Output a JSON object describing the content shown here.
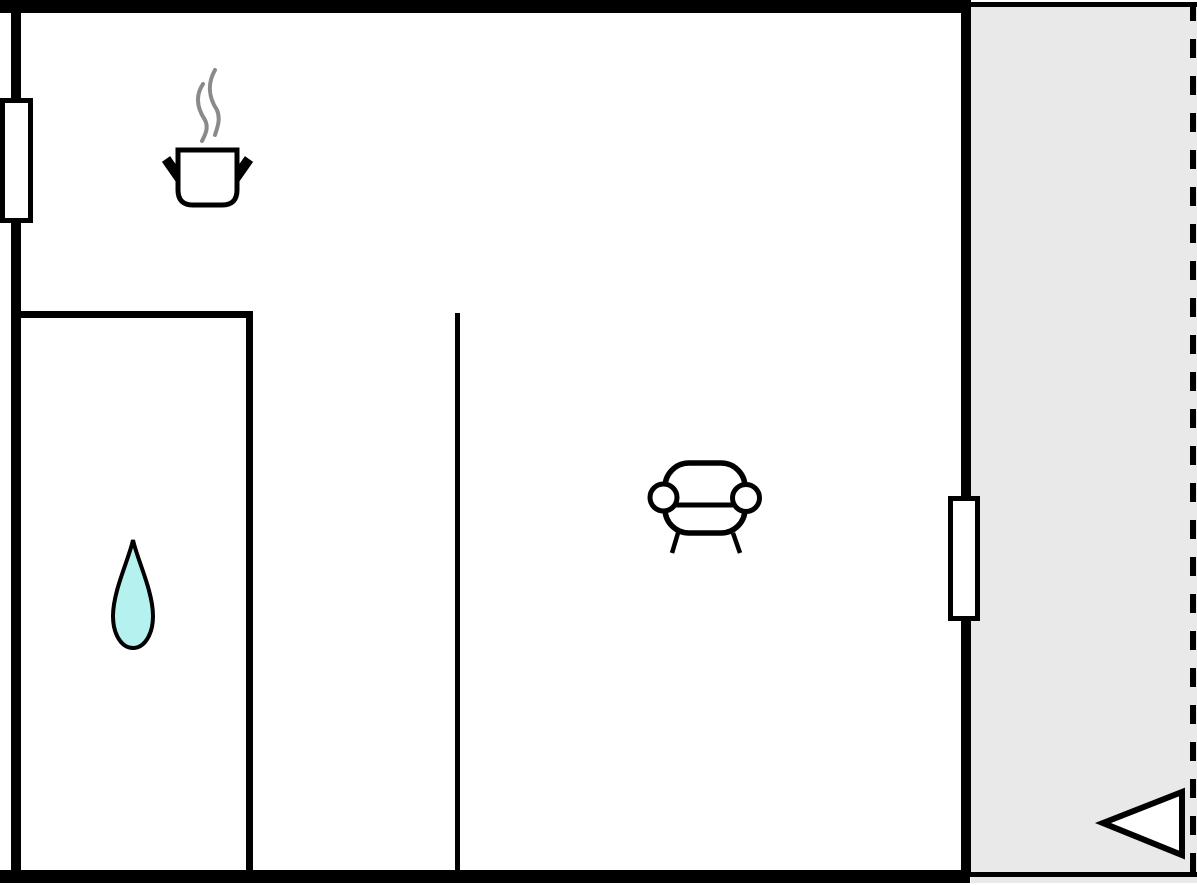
{
  "floorplan": {
    "title": "apartment floor plan",
    "colors": {
      "background": "#ffffff",
      "wall": "#000000",
      "terrace-fill": "#e9e9e9",
      "window-fill": "#ffffff",
      "icon-fill": "#ffffff",
      "drop-fill": "#b5f2ef",
      "steam": "#8a8a8a"
    },
    "rooms": [
      {
        "id": "main-room",
        "icons": [
          "cooking-pot-icon",
          "sofa-icon"
        ]
      },
      {
        "id": "bathroom",
        "icons": [
          "water-drop-icon"
        ]
      },
      {
        "id": "hallway",
        "icons": []
      },
      {
        "id": "terrace",
        "icons": [
          "entrance-arrow-icon"
        ]
      }
    ],
    "icons": [
      {
        "name": "cooking-pot-icon",
        "meaning": "kitchen / cooking area"
      },
      {
        "name": "water-drop-icon",
        "meaning": "bathroom / water point"
      },
      {
        "name": "sofa-icon",
        "meaning": "living area seating"
      },
      {
        "name": "entrance-arrow-icon",
        "meaning": "entrance direction marker"
      }
    ],
    "window_count": 2
  }
}
